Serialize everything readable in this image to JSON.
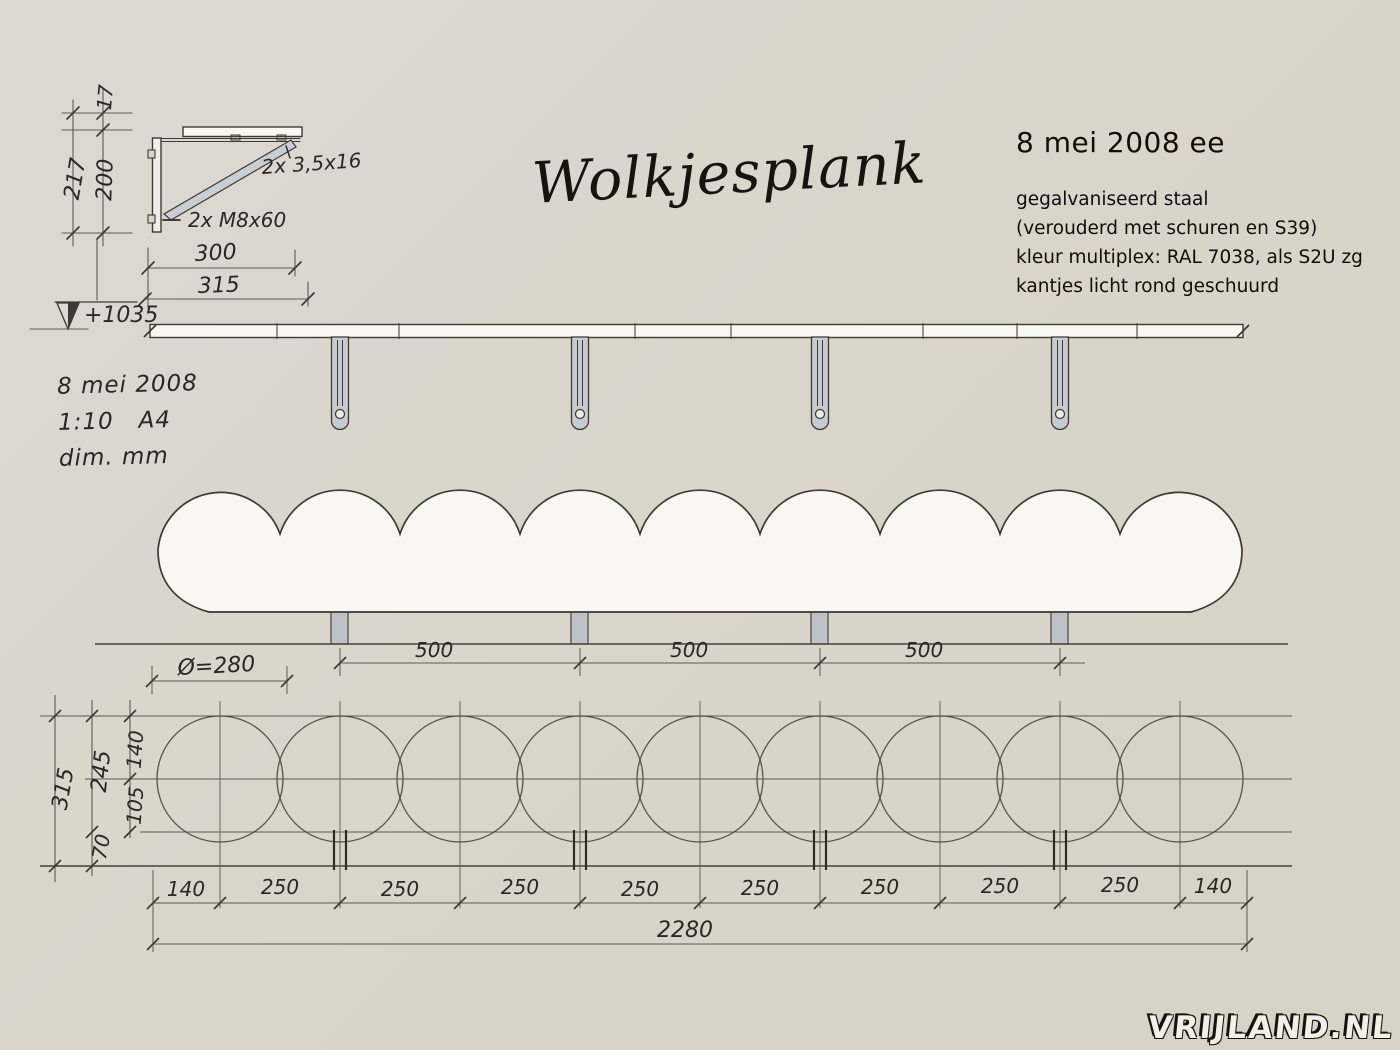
{
  "title": "Wolkjesplank",
  "header_notes": {
    "date_line": "8 mei 2008 ee",
    "lines": [
      "gegalvaniseerd staal",
      "(verouderd met schuren en S39)",
      "kleur multiplex: RAL 7038, als S2U zg",
      "kantjes licht rond geschuurd"
    ]
  },
  "sheet_notes": {
    "date": "8 mei 2008",
    "scale": "1:10   A4",
    "units": "dim. mm"
  },
  "bracket_detail": {
    "dim_thickness": "17",
    "dim_height": "200",
    "dim_total_height": "217",
    "dim_depth": "300",
    "dim_total_depth": "315",
    "level": "+1035",
    "screws_label": "2x 3,5x16",
    "bolts_label": "2x M8x60"
  },
  "front_view": {
    "diameter_label": "Ø=280",
    "spacing_labels": [
      "500",
      "500",
      "500"
    ]
  },
  "plan_view": {
    "dims_vertical": {
      "total": "315",
      "upper": "245",
      "top": "140",
      "mid": "105",
      "front": "70"
    },
    "chain": [
      "140",
      "250",
      "250",
      "250",
      "250",
      "250",
      "250",
      "250",
      "250",
      "140"
    ],
    "overall": "2280"
  },
  "watermark": "VRIJLAND.NL",
  "colors": {
    "background": "#dad5cb",
    "outline": "#3e3a33",
    "dim_line": "#5f5a52",
    "handwriting": "#2b2722",
    "wood_fill": "#f8f7f3",
    "steel_fill": "#c5cbd1"
  }
}
